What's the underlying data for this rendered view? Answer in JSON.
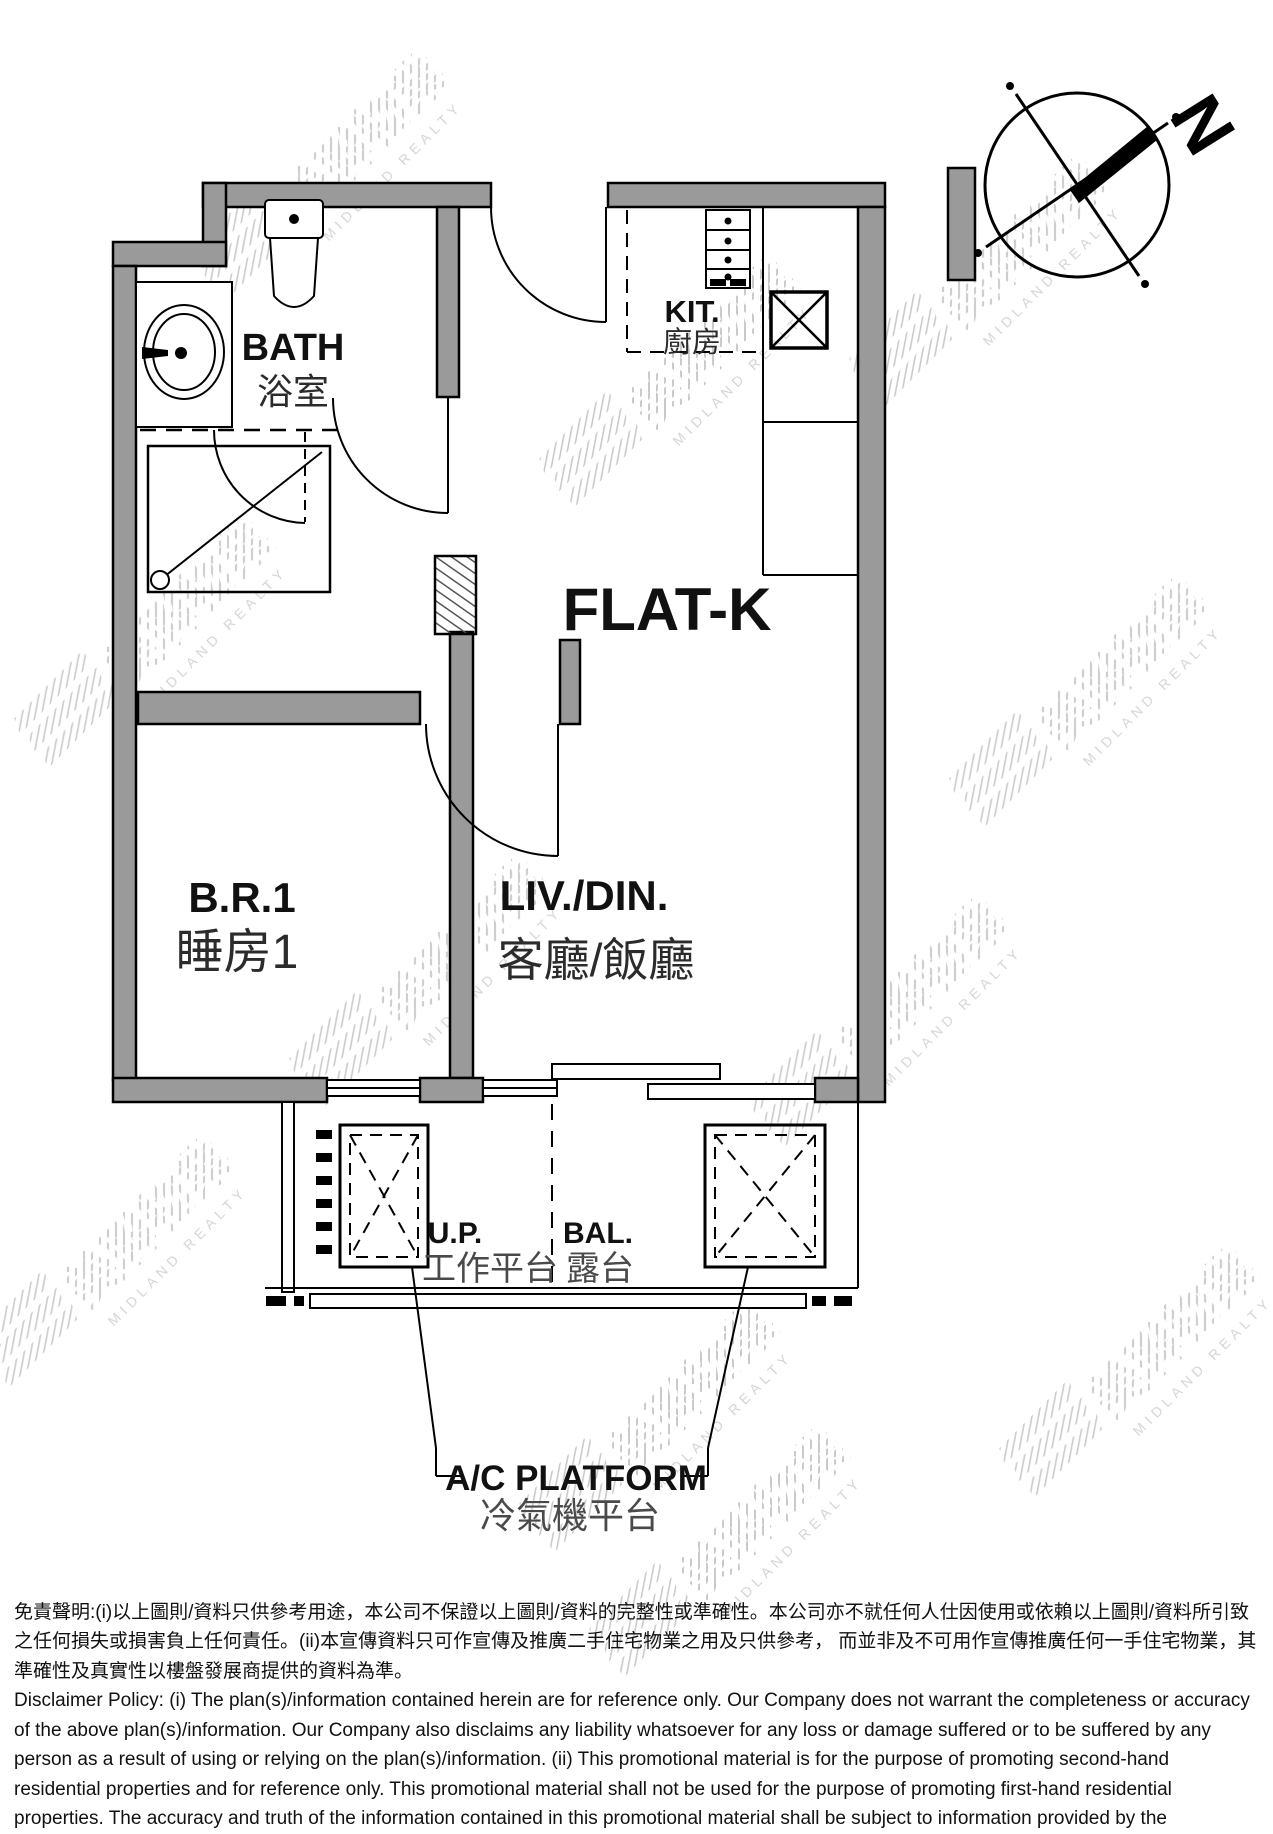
{
  "compass": {
    "north_label": "N"
  },
  "plan": {
    "flat_label": "FLAT-K",
    "rooms": {
      "bath": {
        "en": "BATH",
        "zh": "浴室"
      },
      "kitchen": {
        "en": "KIT.",
        "zh": "廚房"
      },
      "bedroom1": {
        "en": "B.R.1",
        "zh": "睡房1"
      },
      "living_dining": {
        "en": "LIV./DIN.",
        "zh": "客廳/飯廳"
      },
      "utility_platform": {
        "en": "U.P.",
        "zh": "工作平台"
      },
      "balcony": {
        "en": "BAL.",
        "zh": "露台"
      },
      "ac_platform": {
        "en": "A/C PLATFORM",
        "zh": "冷氣機平台"
      }
    }
  },
  "watermark": {
    "zh": "美聯物業",
    "en": "MIDLAND REALTY"
  },
  "colors": {
    "wall_fill": "#9a9a9a",
    "line": "#000000",
    "watermark": "#bdbdbd"
  },
  "disclaimer": {
    "zh": "免責聲明:(i)以上圖則/資料只供參考用途，本公司不保證以上圖則/資料的完整性或準確性。本公司亦不就任何人仕因使用或依賴以上圖則/資料所引致之任何損失或損害負上任何責任。(ii)本宣傳資料只可作宣傳及推廣二手住宅物業之用及只供參考， 而並非及不可用作宣傳推廣任何一手住宅物業，其準確性及真實性以樓盤發展商提供的資料為準。",
    "en": "Disclaimer Policy: (i) The plan(s)/information contained herein are for reference only. Our Company does not warrant the completeness or accuracy of the above plan(s)/information. Our Company also disclaims any liability whatsoever for any loss or damage suffered or to be suffered by any person as a result of using or relying on the plan(s)/information. (ii) This promotional material is for the purpose of promoting second-hand residential properties and for reference only. This promotional material shall not be used for the purpose of promoting first-hand residential properties. The accuracy and truth of the information contained in this promotional material shall be subject to information provided by the developers."
  }
}
